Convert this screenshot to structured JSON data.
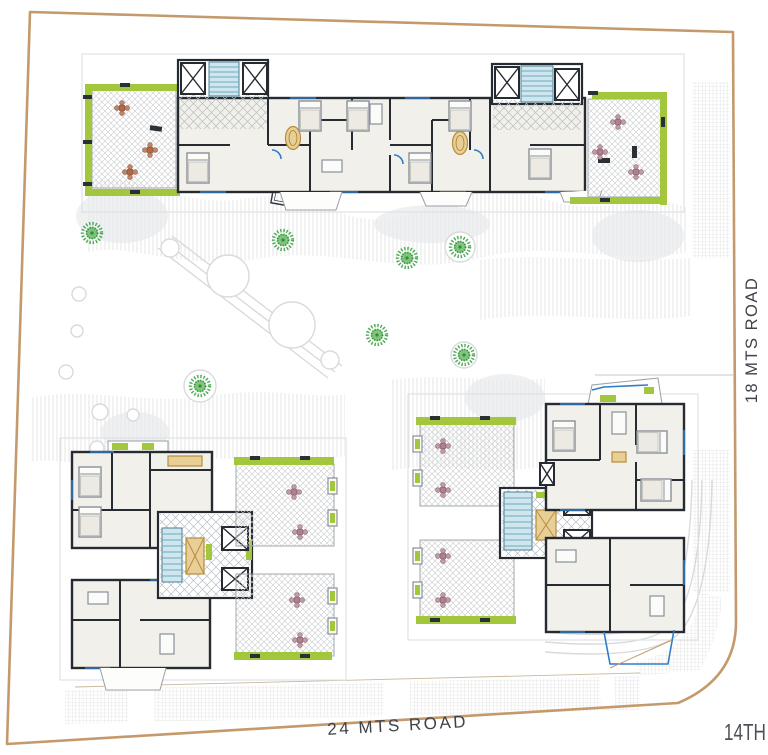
{
  "site_plan": {
    "road_labels": {
      "bottom": "24 MTS ROAD",
      "right": "18 MTS ROAD",
      "corner": "14TH"
    }
  },
  "colors": {
    "site_boundary": "#c49a6c",
    "building_wall": "#262b31",
    "hedge_green": "#a2c73c",
    "tree_green": "#3aa244",
    "stair_cyan": "#cfe6ee",
    "floor_cream": "#f1f0ea",
    "accent_gold": "#d2a74e",
    "door_window_blue": "#2f7dc8",
    "terrace_hatch_gray": "#c9cbcd",
    "road_text_gray": "#3e434a"
  },
  "icons": {
    "tree": "tree-icon",
    "elevator": "elevator-x-icon",
    "stairs": "stairs-icon",
    "outdoor_table": "table-chairs-icon"
  }
}
